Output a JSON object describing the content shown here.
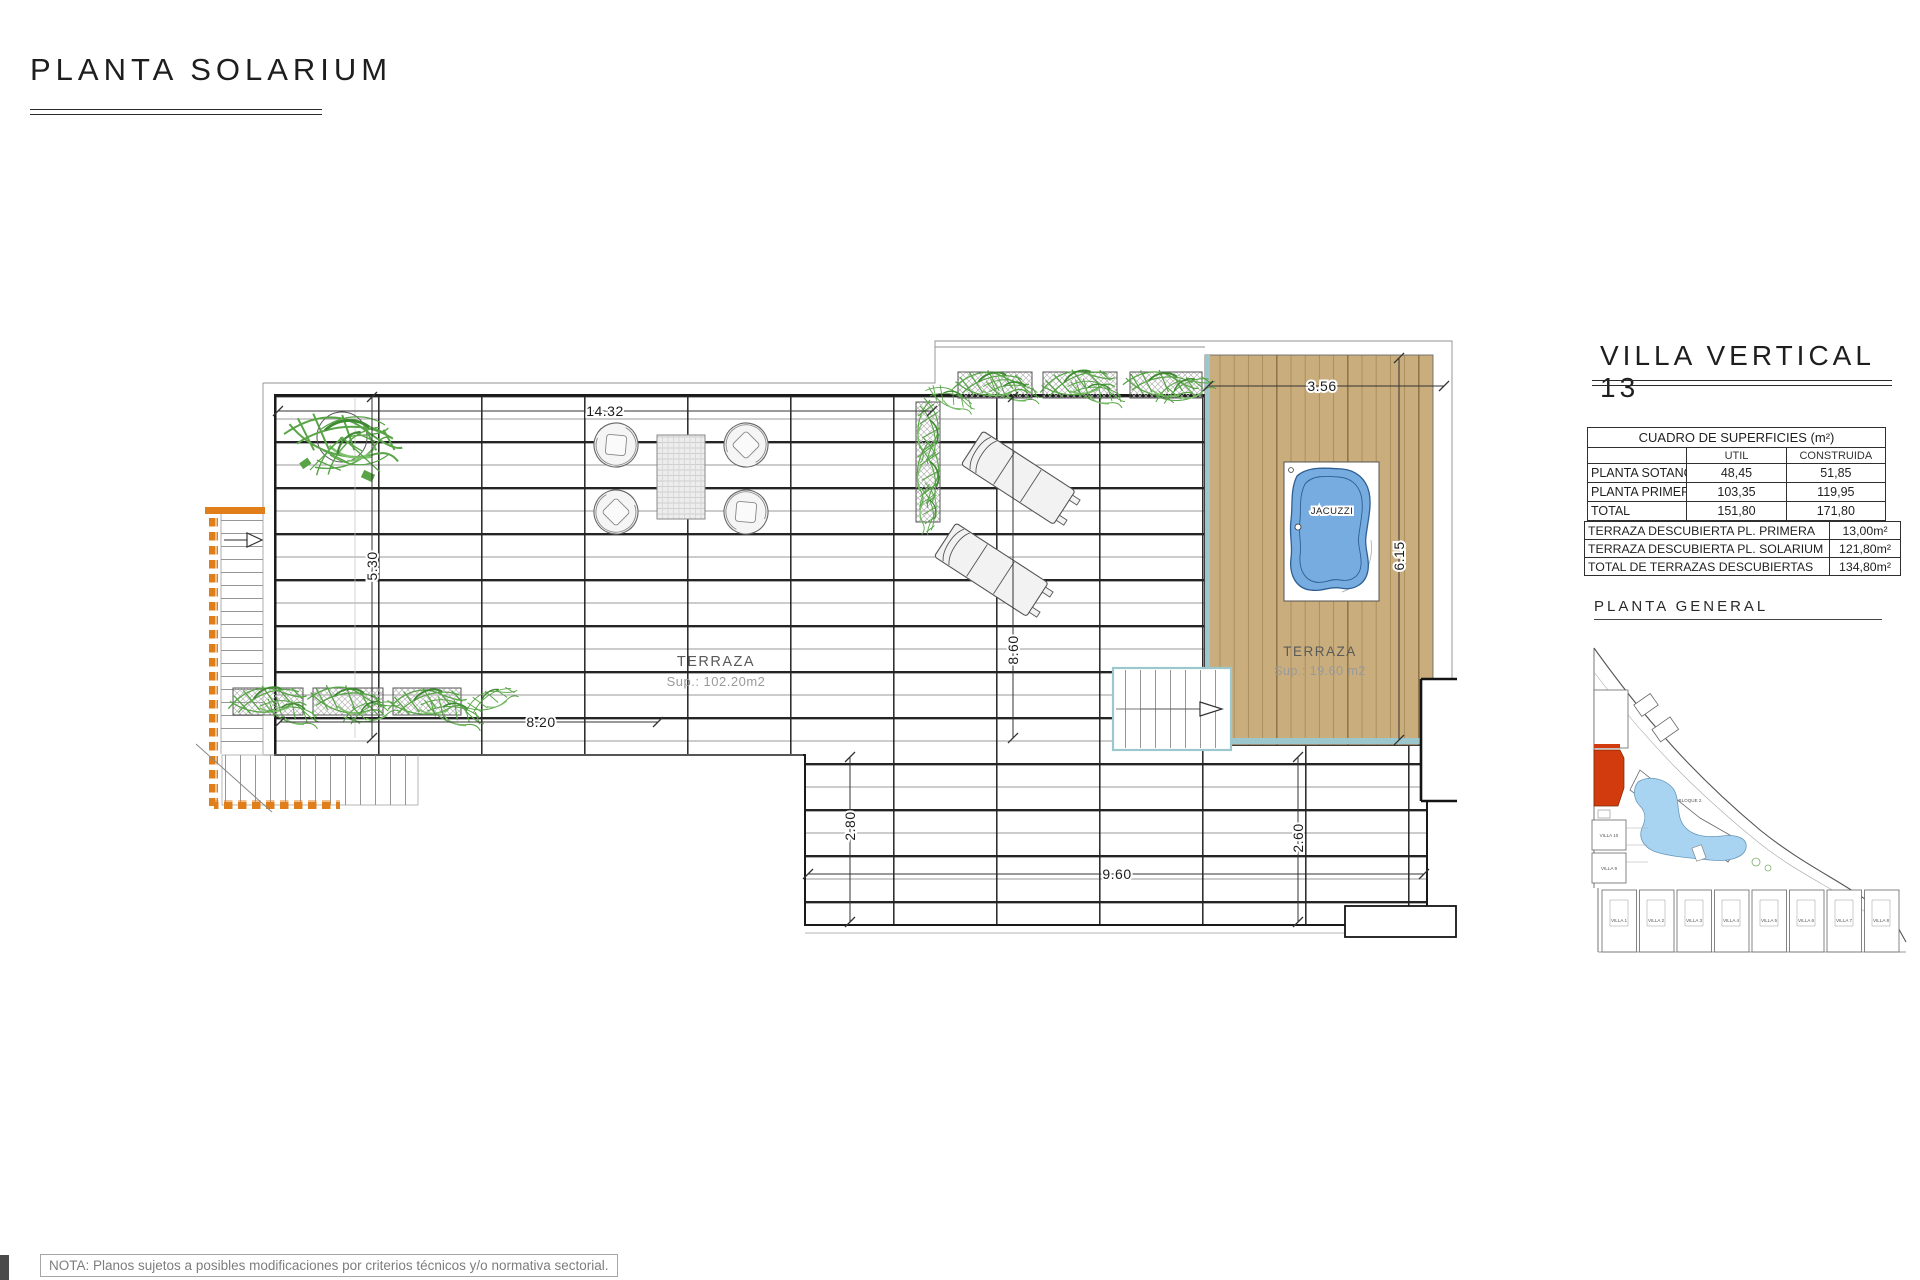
{
  "page": {
    "title": "PLANTA SOLARIUM",
    "note": "NOTA: Planos sujetos a posibles modificaciones por criterios técnicos y/o normativa sectorial."
  },
  "panel": {
    "title": "VILLA VERTICAL 13",
    "surfaces": {
      "title": "CUADRO DE SUPERFICIES (m²)",
      "col_util": "UTIL",
      "col_construida": "CONSTRUIDA",
      "rows": [
        {
          "label": "PLANTA SOTANO",
          "util": "48,45",
          "construida": "51,85"
        },
        {
          "label": "PLANTA PRIMERA",
          "util": "103,35",
          "construida": "119,95"
        },
        {
          "label": "TOTAL",
          "util": "151,80",
          "construida": "171,80"
        }
      ]
    },
    "terrazas": {
      "rows": [
        {
          "label": "TERRAZA DESCUBIERTA PL. PRIMERA",
          "value": "13,00m²"
        },
        {
          "label": "TERRAZA DESCUBIERTA PL. SOLARIUM",
          "value": "121,80m²"
        },
        {
          "label": "TOTAL DE TERRAZAS DESCUBIERTAS",
          "value": "134,80m²"
        }
      ]
    },
    "site": {
      "title": "PLANTA GENERAL",
      "bloque": "BLOQUE 2",
      "villa10": "VILLA 10",
      "villa9": "VILLA 9",
      "villas": [
        "VILLA 1",
        "VILLA 2",
        "VILLA 3",
        "VILLA 4",
        "VILLA 5",
        "VILLA 6",
        "VILLA 7",
        "VILLA 8"
      ]
    }
  },
  "plan": {
    "terrace": {
      "name": "TERRAZA",
      "sup": "Sup.: 102.20m2"
    },
    "deck": {
      "name": "TERRAZA",
      "sup": "Sup.: 19.60 m2",
      "jacuzzi": "JACUZZI"
    },
    "dims": {
      "width_top": "14.32",
      "deck_top": "3.56",
      "left": "5.30",
      "height_mid": "8.60",
      "deck_height": "6.15",
      "bottom_upper": "8.20",
      "lower_left": "2.80",
      "lower_width": "9.60",
      "lower_right": "2.60"
    },
    "colors": {
      "deck_wood": "#C9AD7C",
      "deck_line": "#8d7347",
      "teal_edge": "#9CC7CC",
      "stair_orange": "#E07F1A",
      "plant_green": "#58a447",
      "jacuzzi_blue": "#76ACDF",
      "site_red": "#D23B0E",
      "line_dark": "#1a1a1a"
    }
  }
}
